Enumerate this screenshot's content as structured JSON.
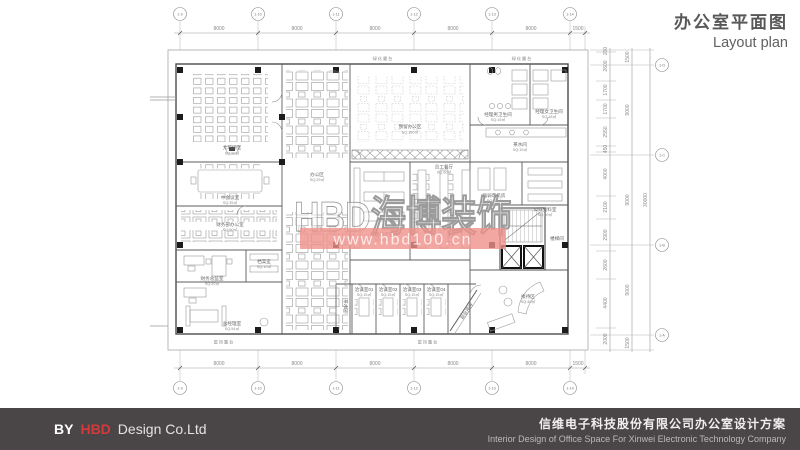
{
  "title": {
    "cn": "办公室平面图",
    "en": "Layout plan"
  },
  "footer": {
    "by": "BY",
    "brand": "HBD",
    "company": "Design Co.Ltd",
    "project_cn": "信维电子科技股份有限公司办公室设计方案",
    "project_en": "Interior Design of Office Space For Xinwei Electronic Technology Company"
  },
  "watermark": {
    "brand": "HBD海博装饰",
    "url": "www.hbd100.cn",
    "band_color": "#ef918c",
    "url_text_color": "#ffeae8"
  },
  "grid": {
    "top_dims": [
      "8000",
      "8000",
      "8000",
      "8000",
      "8000",
      "1500"
    ],
    "bottom_dims": [
      "8000",
      "8000",
      "8000",
      "8000",
      "8000",
      "1500"
    ],
    "top_bubbles": [
      "1-9",
      "1-10",
      "1-11",
      "1-12",
      "1-13",
      "1-14"
    ],
    "bottom_bubbles": [
      "1-9",
      "1-10",
      "1-11",
      "1-12",
      "1-13",
      "1-14"
    ],
    "right_bubbles": [
      "1-D",
      "1-C",
      "1-B",
      "1-A"
    ],
    "right_dims_inner": [
      "200",
      "2600",
      "1700",
      "1700",
      "2550",
      "450",
      "4000",
      "2100",
      "2900",
      "2600",
      "4400",
      "2000"
    ],
    "right_dims_mid": [
      "1500",
      "9000",
      "9000",
      "9000",
      "1500"
    ],
    "right_total": "30000"
  },
  "rooms": {
    "training": {
      "name": "大培训室",
      "area": "SQ:90㎡"
    },
    "meeting": {
      "name": "中会议室",
      "area": "SQ:35㎡"
    },
    "finance": {
      "name": "财务部办公室",
      "area": "SQ:50㎡"
    },
    "finance_director": {
      "name": "财务总监室",
      "area": "SQ:20㎡"
    },
    "archive": {
      "name": "档案室",
      "area": "SQ:10㎡"
    },
    "gm": {
      "name": "总经理室",
      "area": "SQ:54㎡"
    },
    "staff_office": {
      "name": "办公区",
      "area": "SQ:25㎡"
    },
    "reserved": {
      "name": "预留办公区",
      "area": "SQ:150㎡"
    },
    "male_wc": {
      "name": "经理男卫生间",
      "area": "SQ:15㎡"
    },
    "female_wc": {
      "name": "经理女卫生间",
      "area": "SQ:18㎡"
    },
    "pantry": {
      "name": "茶水间",
      "area": "SQ:15㎡"
    },
    "elec_room": {
      "name": "强弱电机房",
      "area": "SQ:10㎡"
    },
    "public_archive": {
      "name": "公共资料室",
      "area": "SQ:50㎡"
    },
    "stair": {
      "name": "楼梯间"
    },
    "reception": {
      "name": "接待区",
      "area": "SQ:40㎡"
    },
    "sample": {
      "name": "样品展示室",
      "area": "SQ:40㎡"
    },
    "canteen": {
      "name": "员工餐厅",
      "area": "SQ:50㎡"
    },
    "talk1": {
      "name": "洽谈室01",
      "area": "SQ:15㎡"
    },
    "talk2": {
      "name": "洽谈室02",
      "area": "SQ:15㎡"
    },
    "talk3": {
      "name": "洽谈室03",
      "area": "SQ:15㎡"
    },
    "talk4": {
      "name": "洽谈室04",
      "area": "SQ:15㎡"
    },
    "front_desk": {
      "name": "前台接待"
    },
    "tea": {
      "name": "茶水区"
    },
    "green_terrace": {
      "name": "绿化露台"
    },
    "roof_terrace": {
      "name": "屋顶露台"
    }
  }
}
